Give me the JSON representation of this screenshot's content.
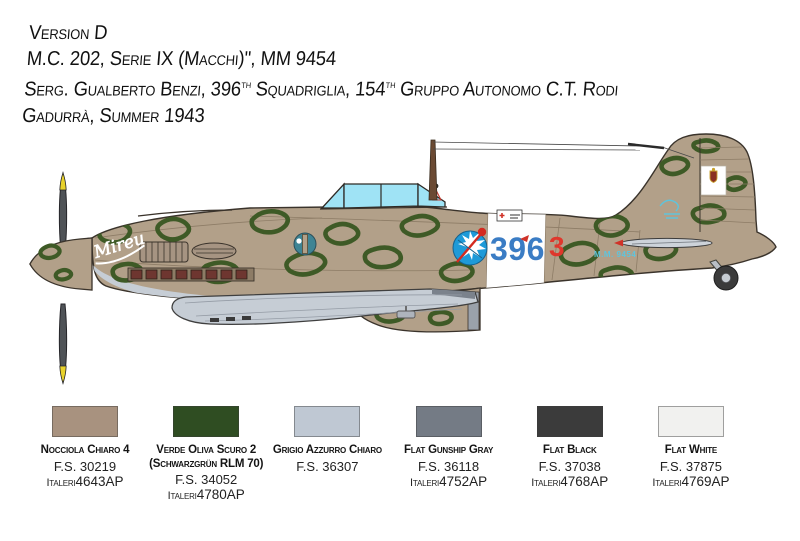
{
  "header": {
    "version": "Version D",
    "aircraft_line": "M.C. 202, Serie IX (Macchi)\", MM 9454",
    "pilot_line": {
      "p1": "Serg. Gualberto Benzi, 396",
      "sup1": "th",
      "p2": " Squadriglia, 154",
      "sup2": "th",
      "p3": " Gruppo Autonomo C.T. Rodi"
    },
    "location_line": "Gadurrà, Summer 1943"
  },
  "profile": {
    "nose_script": "Mireu",
    "band_number": "396",
    "individual_number": "3",
    "serial": "M.M. 9454",
    "colors": {
      "camouflage_base_tan": "#b2a089",
      "camouflage_green": "#3e5a26",
      "underside_gray": "#c6cdd5",
      "fuselage_band": "#ffffff",
      "band_number_blue": "#3a7cc4",
      "individual_number_red": "#df372c",
      "badge_blue": "#1e9ad8",
      "canopy_glass": "#9fe3f5",
      "propeller": "#4f5357",
      "propeller_tip_yellow": "#e8d22c",
      "stencil_light_blue": "#5fc4dc"
    }
  },
  "paints": [
    {
      "name": "Nocciola Chiaro 4",
      "alt": "",
      "fs": "F.S. 30219",
      "brand": "Italeri",
      "code": "4643AP",
      "hex": "#a8927f"
    },
    {
      "name": "Verde Oliva Scuro 2",
      "alt": "(Schwarzgrün RLM 70)",
      "fs": "F.S. 34052",
      "brand": "Italeri",
      "code": "4780AP",
      "hex": "#2f4d22"
    },
    {
      "name": "Grigio Azzurro Chiaro",
      "alt": "",
      "fs": "F.S. 36307",
      "brand": "",
      "code": "",
      "hex": "#bfc8d3"
    },
    {
      "name": "Flat Gunship Gray",
      "alt": "",
      "fs": "F.S. 36118",
      "brand": "Italeri",
      "code": "4752AP",
      "hex": "#747b85"
    },
    {
      "name": "Flat Black",
      "alt": "",
      "fs": "F.S. 37038",
      "brand": "Italeri",
      "code": "4768AP",
      "hex": "#3b3b3b"
    },
    {
      "name": "Flat White",
      "alt": "",
      "fs": "F.S. 37875",
      "brand": "Italeri",
      "code": "4769AP",
      "hex": "#f1f1ef"
    }
  ]
}
